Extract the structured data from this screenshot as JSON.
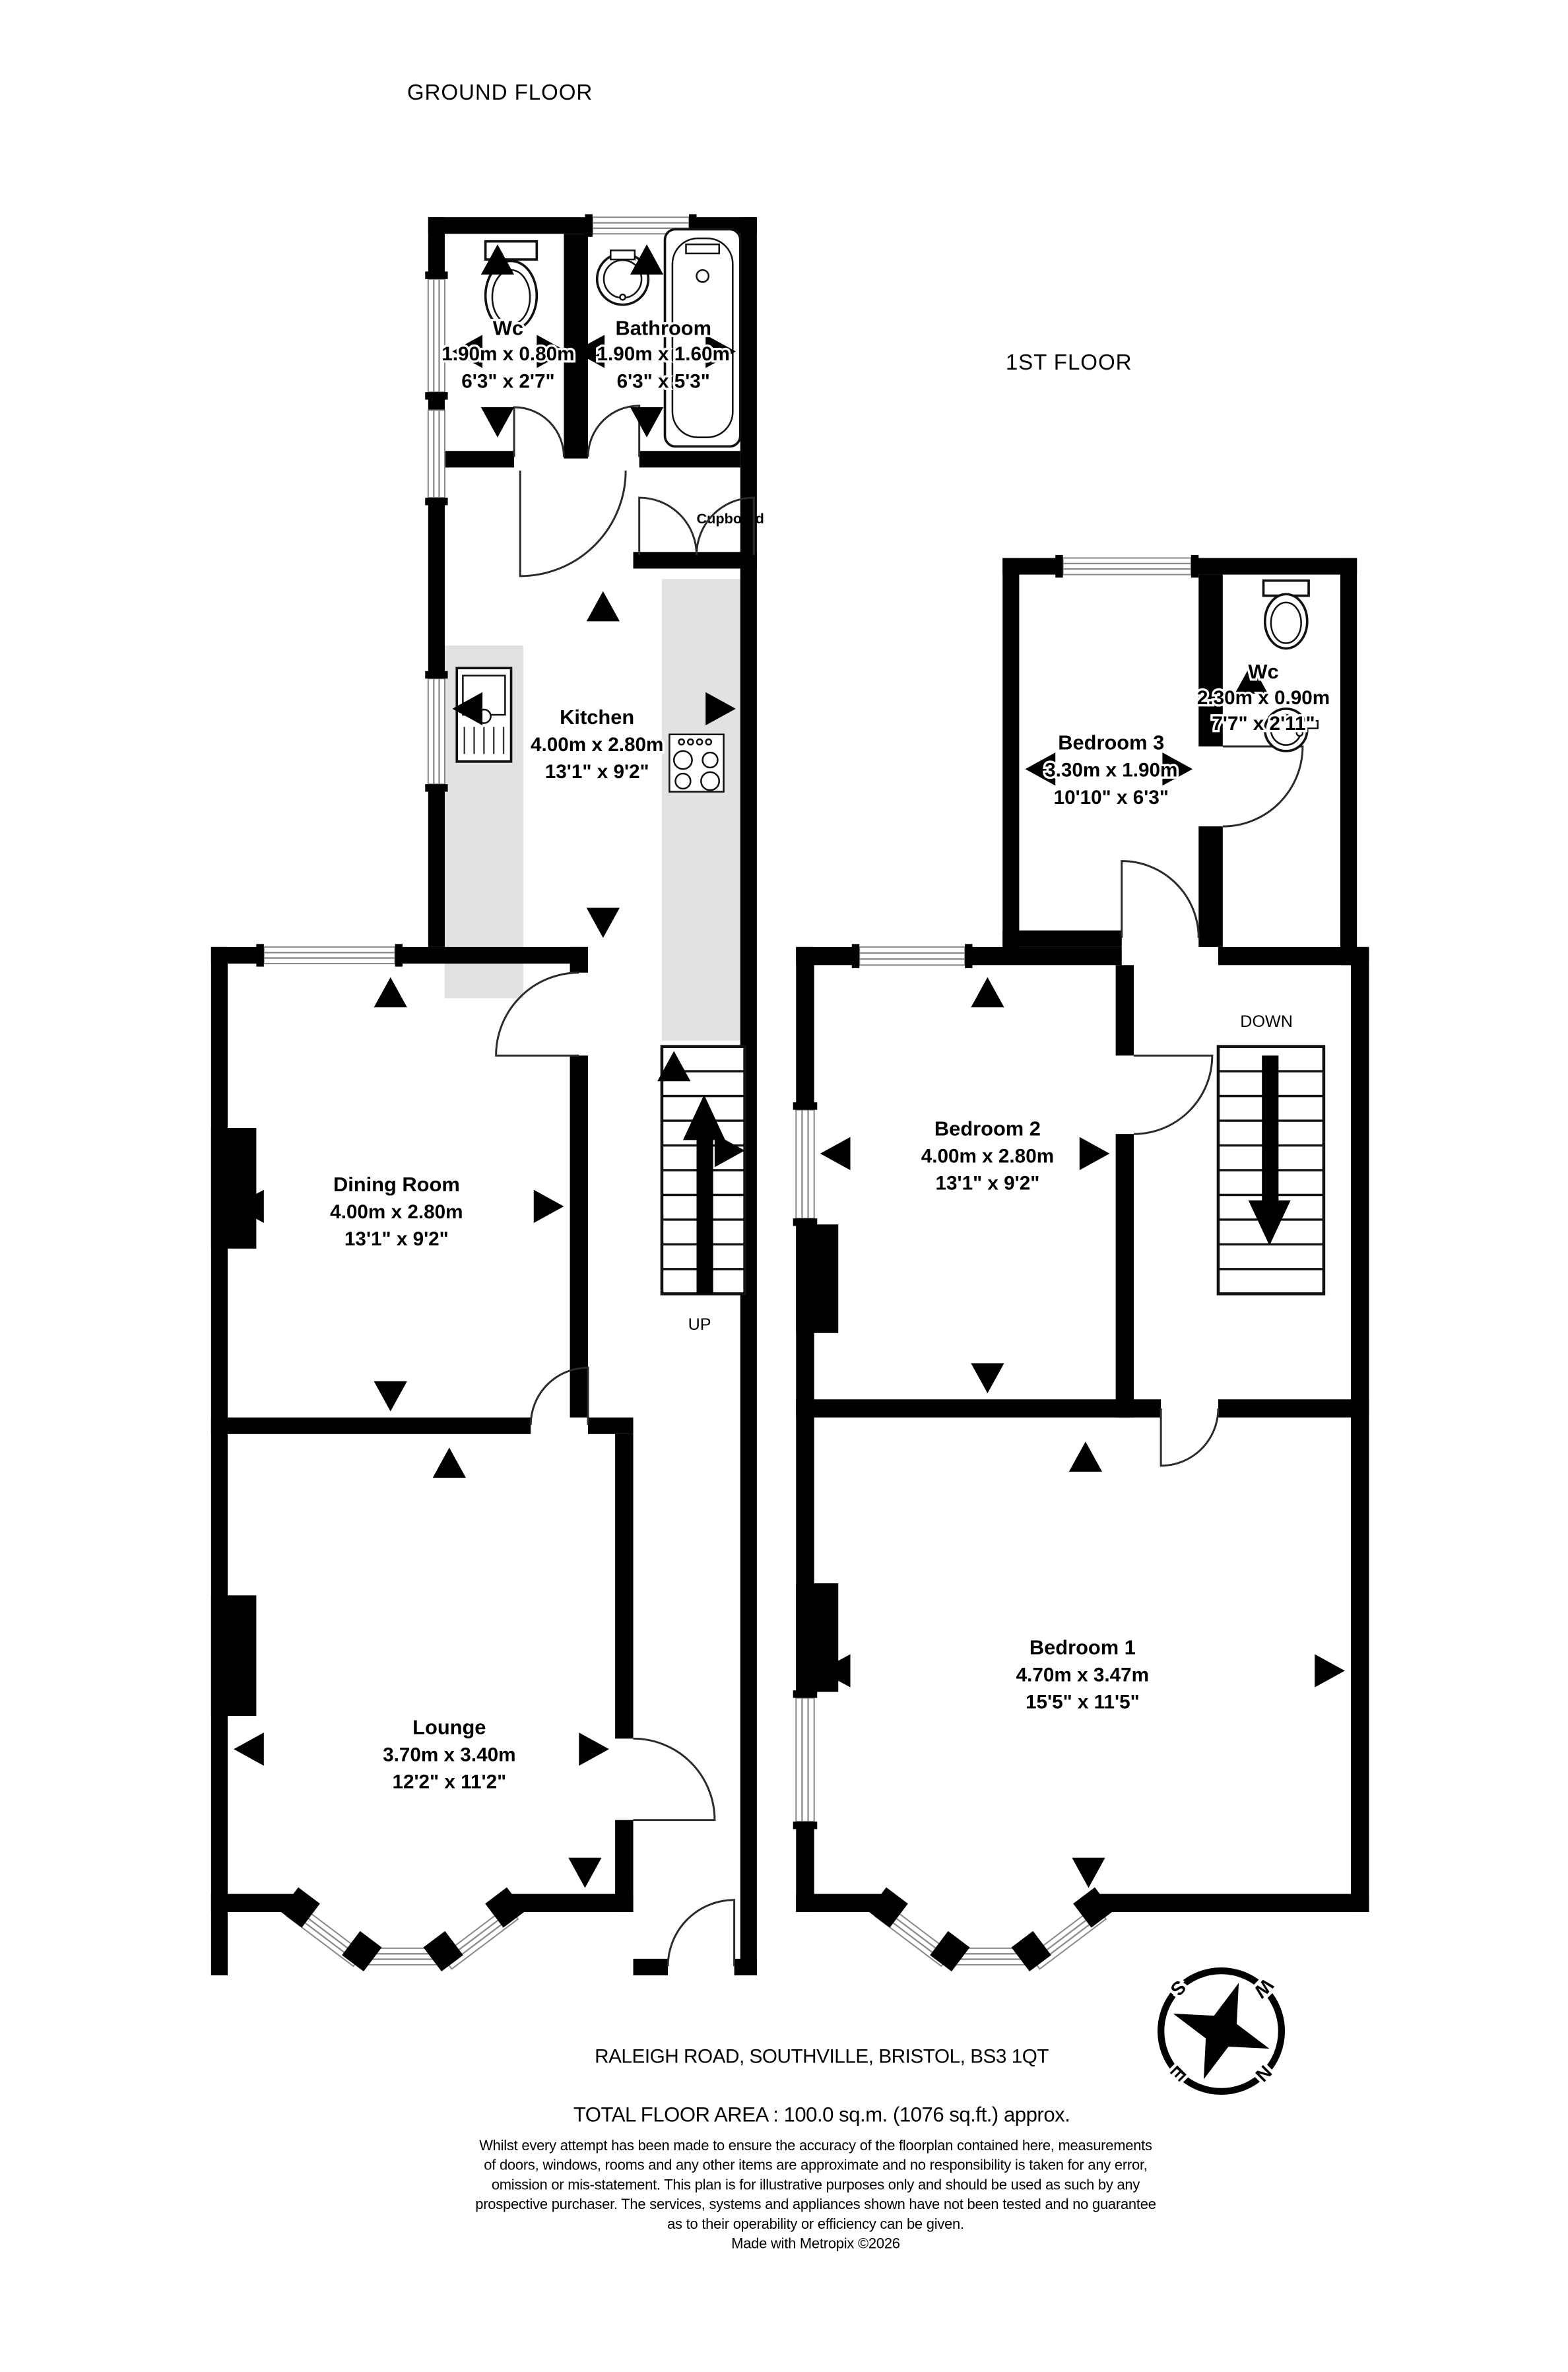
{
  "colors": {
    "wall": "#000000",
    "counter": "#e2e2e2",
    "window_line": "#8a8a8a",
    "background": "#ffffff"
  },
  "titles": {
    "ground": "GROUND FLOOR",
    "first": "1ST FLOOR"
  },
  "rooms": {
    "wc_ground": {
      "name": "Wc",
      "metric": "1.90m  x 0.80m",
      "imperial": "6'3\"  x 2'7\""
    },
    "bathroom": {
      "name": "Bathroom",
      "metric": "1.90m  x 1.60m",
      "imperial": "6'3\"  x 5'3\""
    },
    "kitchen": {
      "name": "Kitchen",
      "metric": "4.00m  x 2.80m",
      "imperial": "13'1\"  x 9'2\""
    },
    "dining_room": {
      "name": "Dining Room",
      "metric": "4.00m  x 2.80m",
      "imperial": "13'1\"  x 9'2\""
    },
    "lounge": {
      "name": "Lounge",
      "metric": "3.70m  x 3.40m",
      "imperial": "12'2\"  x 11'2\""
    },
    "bedroom3": {
      "name": "Bedroom 3",
      "metric": "3.30m  x 1.90m",
      "imperial": "10'10\"  x 6'3\""
    },
    "wc_first": {
      "name": "Wc",
      "metric": "2.30m  x 0.90m",
      "imperial": "7'7\"  x 2'11\""
    },
    "bedroom2": {
      "name": "Bedroom 2",
      "metric": "4.00m  x 2.80m",
      "imperial": "13'1\"  x 9'2\""
    },
    "bedroom1": {
      "name": "Bedroom 1",
      "metric": "4.70m  x 3.47m",
      "imperial": "15'5\"  x 11'5\""
    }
  },
  "labels": {
    "cupboard": "Cupboard",
    "stairs_up": "UP",
    "stairs_down": "DOWN"
  },
  "compass": {
    "north": "N",
    "east": "E",
    "south": "S",
    "west": "W"
  },
  "footer": {
    "address": "RALEIGH ROAD, SOUTHVILLE, BRISTOL, BS3 1QT",
    "total_area": "TOTAL FLOOR AREA : 100.0 sq.m. (1076 sq.ft.) approx.",
    "disclaimer_lines": [
      "Whilst every attempt has been made to ensure the accuracy of the floorplan contained here, measurements",
      "of doors, windows, rooms and any other items are approximate and no responsibility is taken for any error,",
      "omission or mis-statement. This plan is for illustrative purposes only and should be used as such by any",
      "prospective purchaser. The services, systems and appliances shown have not been tested and no guarantee",
      "as to their operability or efficiency can be given."
    ],
    "credit": "Made with Metropix ©2026"
  }
}
